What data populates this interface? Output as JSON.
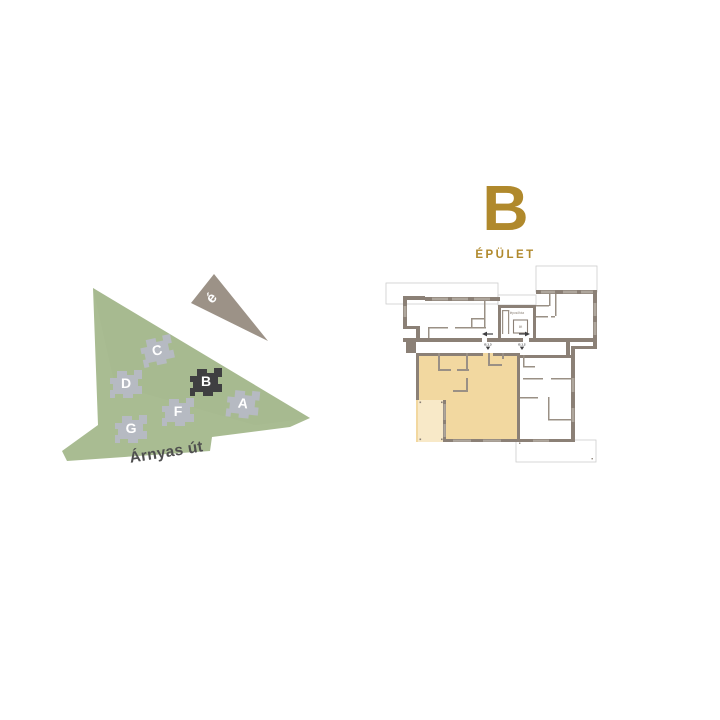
{
  "page": {
    "background": "#ffffff"
  },
  "site_plan": {
    "street_label": "Árnyas út",
    "street_label_color": "#4f4f4f",
    "compass_label": "é",
    "compass_color": "#9c9287",
    "area_color": "#a9bc92",
    "building_color": "#b6bac2",
    "highlight_building_color": "#3f3f41",
    "buildings": [
      {
        "label": "C",
        "highlighted": false
      },
      {
        "label": "D",
        "highlighted": false
      },
      {
        "label": "B",
        "highlighted": true
      },
      {
        "label": "A",
        "highlighted": false
      },
      {
        "label": "F",
        "highlighted": false
      },
      {
        "label": "G",
        "highlighted": false
      }
    ]
  },
  "building_panel": {
    "letter": "B",
    "subtitle": "ÉPÜLET",
    "accent_color": "#b0892c"
  },
  "floor_plan": {
    "stair_core_label": "lépcsőház",
    "lift_label": "lift",
    "unit_labels": [
      "B.1.3",
      "B.1.2"
    ],
    "wall_color": "#8b8076",
    "window_color": "#aea69c",
    "outline_color": "#cdcdcd",
    "highlight_color": "#f2d8a0",
    "terrace_color": "#f8e9c8",
    "marker_color": "#3f3f41"
  }
}
